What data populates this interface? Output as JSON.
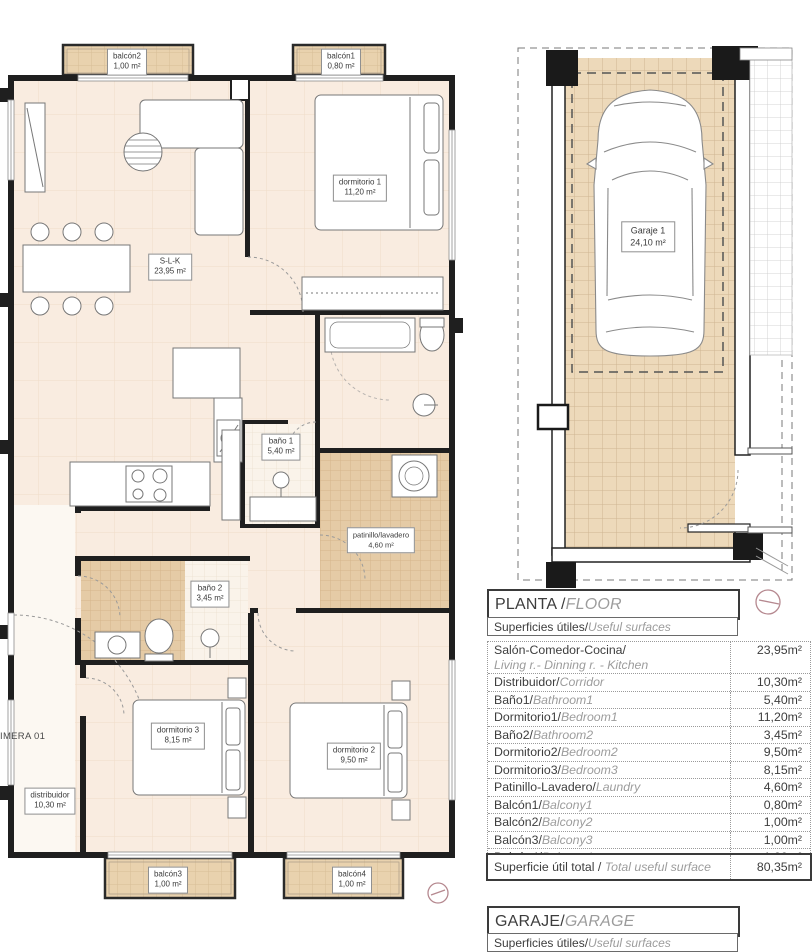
{
  "apartment_plan": {
    "edge_label": "IMERA 01",
    "rooms": [
      {
        "id": "balcon2",
        "name": "balcón2",
        "area": "1,00 m²"
      },
      {
        "id": "balcon1",
        "name": "balcón1",
        "area": "0,80 m²"
      },
      {
        "id": "dormitorio1",
        "name": "dormitorio 1",
        "area": "11,20 m²"
      },
      {
        "id": "slk",
        "name": "S-L-K",
        "area": "23,95 m²"
      },
      {
        "id": "bano1",
        "name": "baño 1",
        "area": "5,40 m²"
      },
      {
        "id": "patinillo",
        "name": "patinillo/lavadero",
        "area": "4,60 m²"
      },
      {
        "id": "bano2",
        "name": "baño 2",
        "area": "3,45 m²"
      },
      {
        "id": "dormitorio3",
        "name": "dormitorio 3",
        "area": "8,15 m²"
      },
      {
        "id": "dormitorio2",
        "name": "dormitorio 2",
        "area": "9,50 m²"
      },
      {
        "id": "distribuidor",
        "name": "distribuidor",
        "area": "10,30 m²"
      },
      {
        "id": "balcon3",
        "name": "balcón3",
        "area": "1,00 m²"
      },
      {
        "id": "balcon4",
        "name": "balcón4",
        "area": "1,00 m²"
      }
    ]
  },
  "garage_plan": {
    "room": {
      "name": "Garaje 1",
      "area": "24,10 m²"
    }
  },
  "surfaces_panel": {
    "title": {
      "es": "PLANTA / ",
      "en": "FLOOR"
    },
    "subtitle": {
      "es": "Superficies útiles/",
      "en": "Useful surfaces"
    },
    "rows": [
      {
        "es": "Salón-Comedor-Cocina/",
        "en": "Living r.- Dinning r. - Kitchen",
        "value": "23,95m²"
      },
      {
        "es": "Distribuidor/",
        "en": "Corridor",
        "value": "10,30m²"
      },
      {
        "es": "Baño1/",
        "en": "Bathroom1",
        "value": "5,40m²"
      },
      {
        "es": "Dormitorio1/",
        "en": "Bedroom1",
        "value": "11,20m²"
      },
      {
        "es": "Baño2/",
        "en": "Bathroom2",
        "value": "3,45m²"
      },
      {
        "es": "Dormitorio2/",
        "en": "Bedroom2",
        "value": "9,50m²"
      },
      {
        "es": "Dormitorio3/",
        "en": "Bedroom3",
        "value": "8,15m²"
      },
      {
        "es": "Patinillo-Lavadero/",
        "en": "Laundry",
        "value": "4,60m²"
      },
      {
        "es": "Balcón1/",
        "en": "Balcony1",
        "value": "0,80m²"
      },
      {
        "es": "Balcón2/",
        "en": "Balcony2",
        "value": "1,00m²"
      },
      {
        "es": "Balcón3/",
        "en": "Balcony3",
        "value": "1,00m²"
      },
      {
        "es": "Balcón4/",
        "en": "Balcony4",
        "value": "1,00m²"
      }
    ],
    "total": {
      "es": "Superficie útil total / ",
      "en": "Total useful surface",
      "value": "80,35m²"
    }
  },
  "garage_panel": {
    "title": {
      "es": "GARAJE/",
      "en": "GARAGE"
    },
    "subtitle": {
      "es": "Superficies útiles/",
      "en": "Useful surfaces"
    }
  },
  "colors": {
    "floor": "#f9ece0",
    "tile": "#e9d2ae",
    "tile_dark": "#e3c9a4",
    "wall": "#1f1f1f",
    "marker": "#b5888f",
    "text_dark": "#3d3d3d",
    "text_gray": "#9c9c9c"
  }
}
